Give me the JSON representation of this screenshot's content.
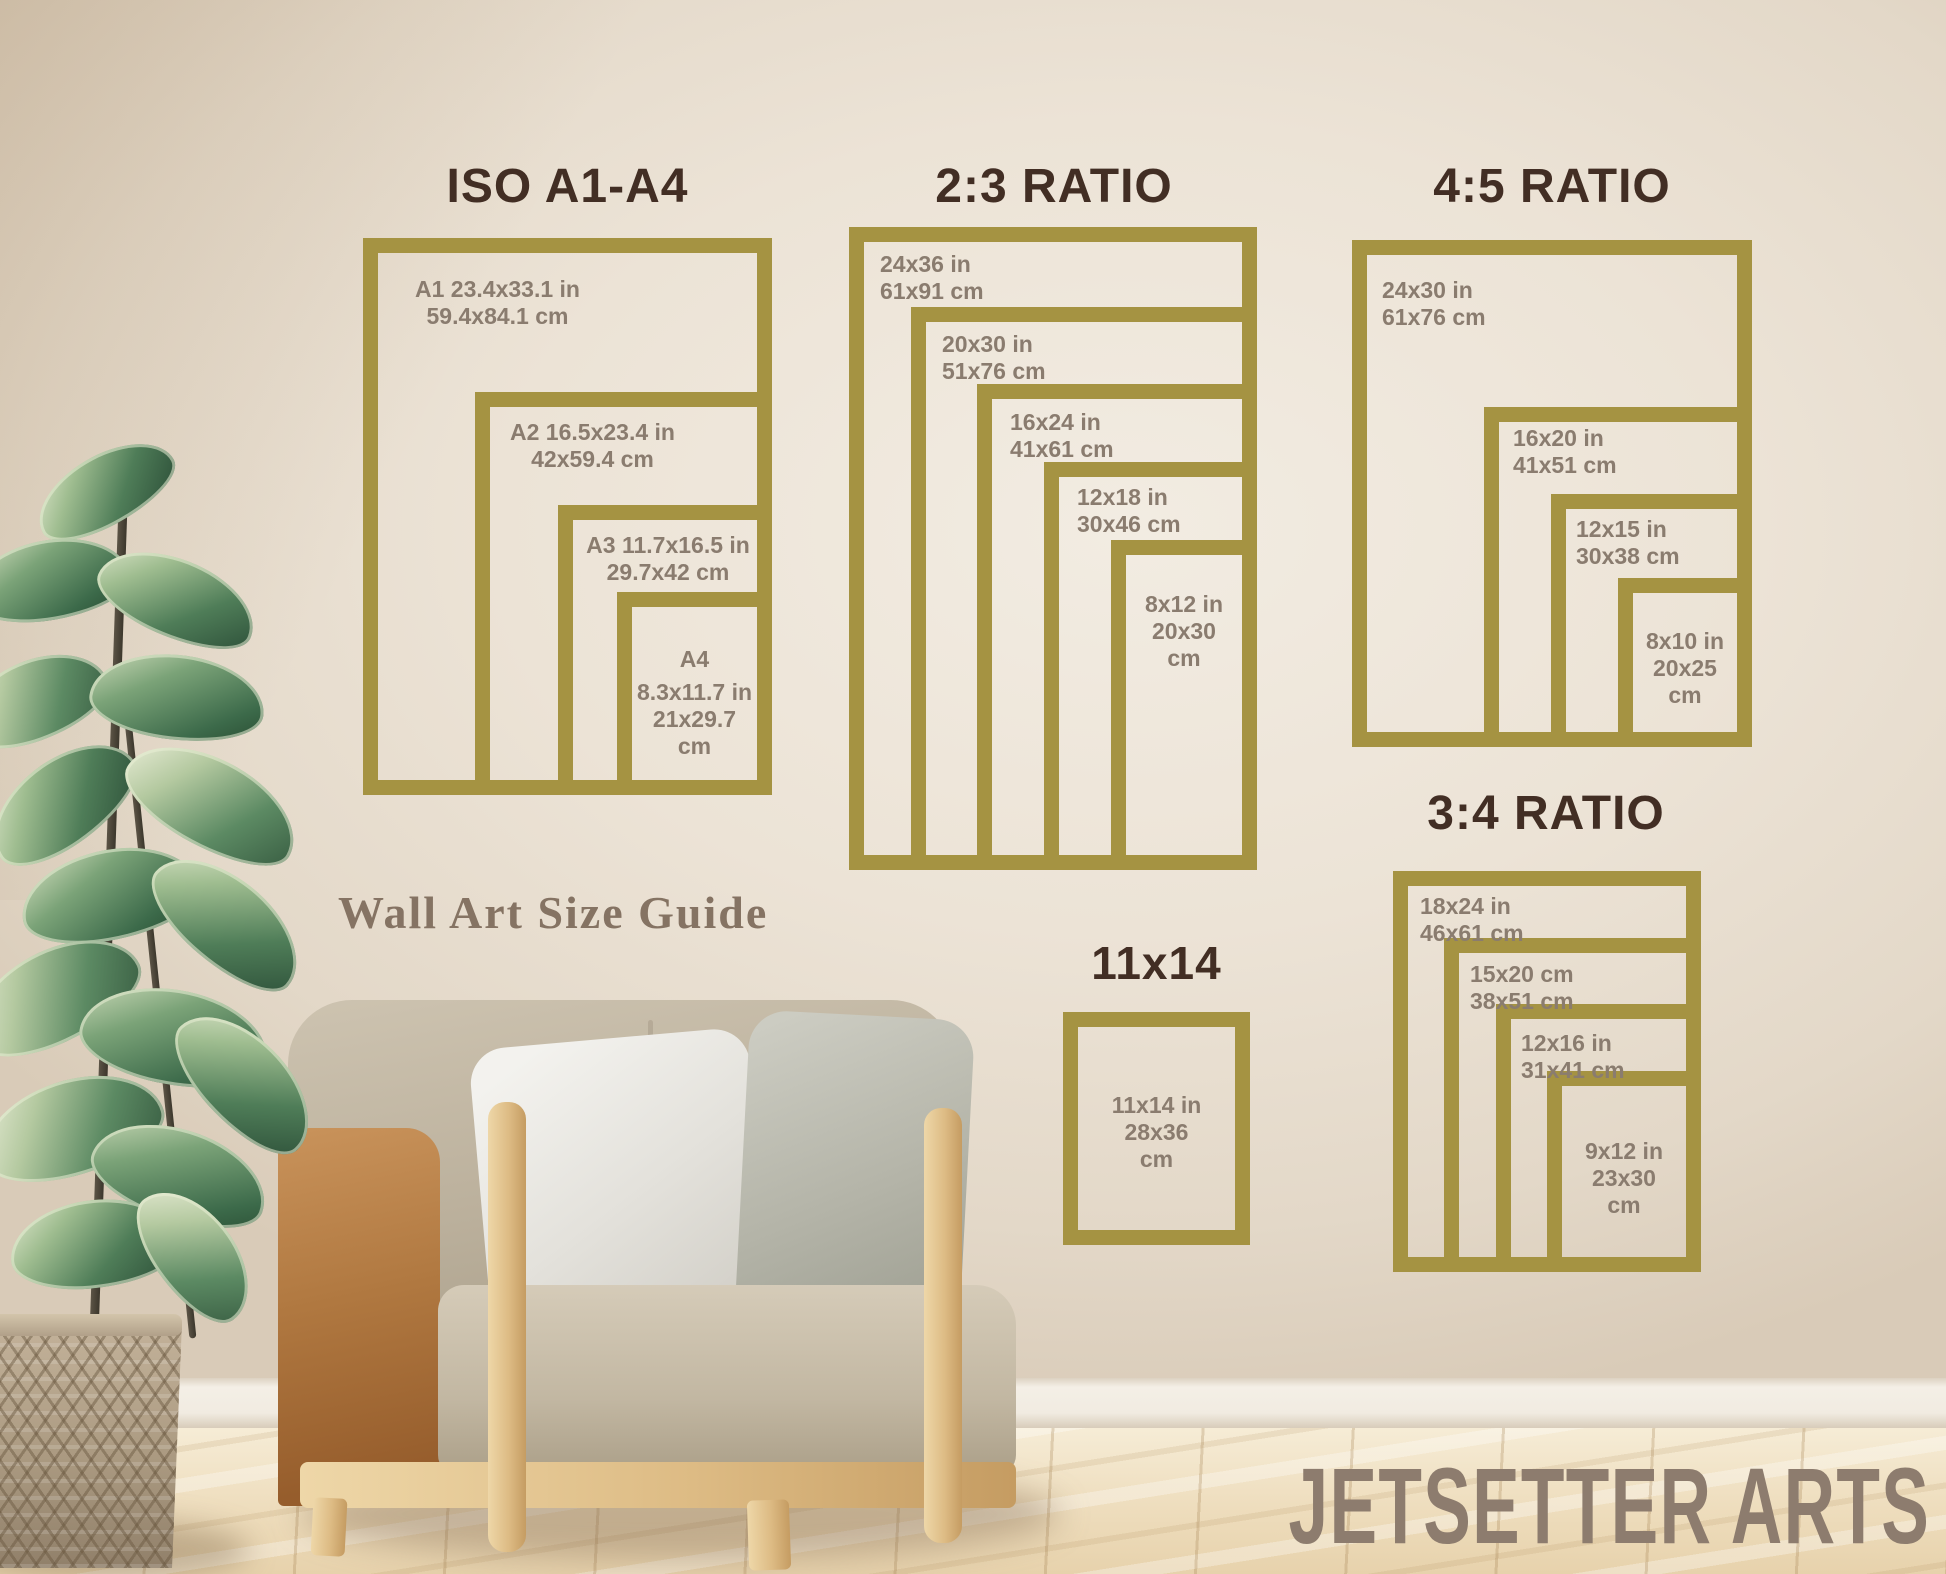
{
  "brand": "JETSETTER ARTS",
  "wall_text": "Wall Art Size Guide",
  "colors": {
    "frame_gold": "#a59342",
    "title_brown": "#422e24",
    "label_taupe": "#8a7c6f",
    "brand_taupe": "#8d7c6e",
    "wall_text_color": "#857363"
  },
  "sections": {
    "iso": {
      "title": "ISO A1-A4",
      "frames": [
        {
          "name": "A1",
          "lines": [
            "A1 23.4x33.1 in",
            "59.4x84.1 cm"
          ]
        },
        {
          "name": "A2",
          "lines": [
            "A2 16.5x23.4 in",
            "42x59.4 cm"
          ]
        },
        {
          "name": "A3",
          "lines": [
            "A3 11.7x16.5 in",
            "29.7x42 cm"
          ]
        },
        {
          "name": "A4",
          "lines": [
            "A4",
            "8.3x11.7 in",
            "21x29.7",
            "cm"
          ]
        }
      ]
    },
    "ratio23": {
      "title": "2:3 RATIO",
      "frames": [
        {
          "name": "24x36",
          "lines": [
            "24x36 in",
            "61x91 cm"
          ]
        },
        {
          "name": "20x30",
          "lines": [
            "20x30 in",
            "51x76 cm"
          ]
        },
        {
          "name": "16x24",
          "lines": [
            "16x24 in",
            "41x61 cm"
          ]
        },
        {
          "name": "12x18",
          "lines": [
            "12x18 in",
            "30x46 cm"
          ]
        },
        {
          "name": "8x12",
          "lines": [
            "8x12 in",
            "20x30",
            "cm"
          ]
        }
      ]
    },
    "ratio45": {
      "title": "4:5 RATIO",
      "frames": [
        {
          "name": "24x30",
          "lines": [
            "24x30 in",
            "61x76 cm"
          ]
        },
        {
          "name": "16x20",
          "lines": [
            "16x20 in",
            "41x51 cm"
          ]
        },
        {
          "name": "12x15",
          "lines": [
            "12x15 in",
            "30x38 cm"
          ]
        },
        {
          "name": "8x10",
          "lines": [
            "8x10 in",
            "20x25",
            "cm"
          ]
        }
      ]
    },
    "ratio34": {
      "title": "3:4 RATIO",
      "frames": [
        {
          "name": "18x24",
          "lines": [
            "18x24 in",
            "46x61 cm"
          ]
        },
        {
          "name": "15x20",
          "lines": [
            "15x20 cm",
            "38x51 cm"
          ]
        },
        {
          "name": "12x16",
          "lines": [
            "12x16 in",
            "31x41 cm"
          ]
        },
        {
          "name": "9x12",
          "lines": [
            "9x12 in",
            "23x30",
            "cm"
          ]
        }
      ]
    },
    "s1114": {
      "title": "11x14",
      "frames": [
        {
          "name": "11x14",
          "lines": [
            "11x14 in",
            "28x36",
            "cm"
          ]
        }
      ]
    }
  }
}
